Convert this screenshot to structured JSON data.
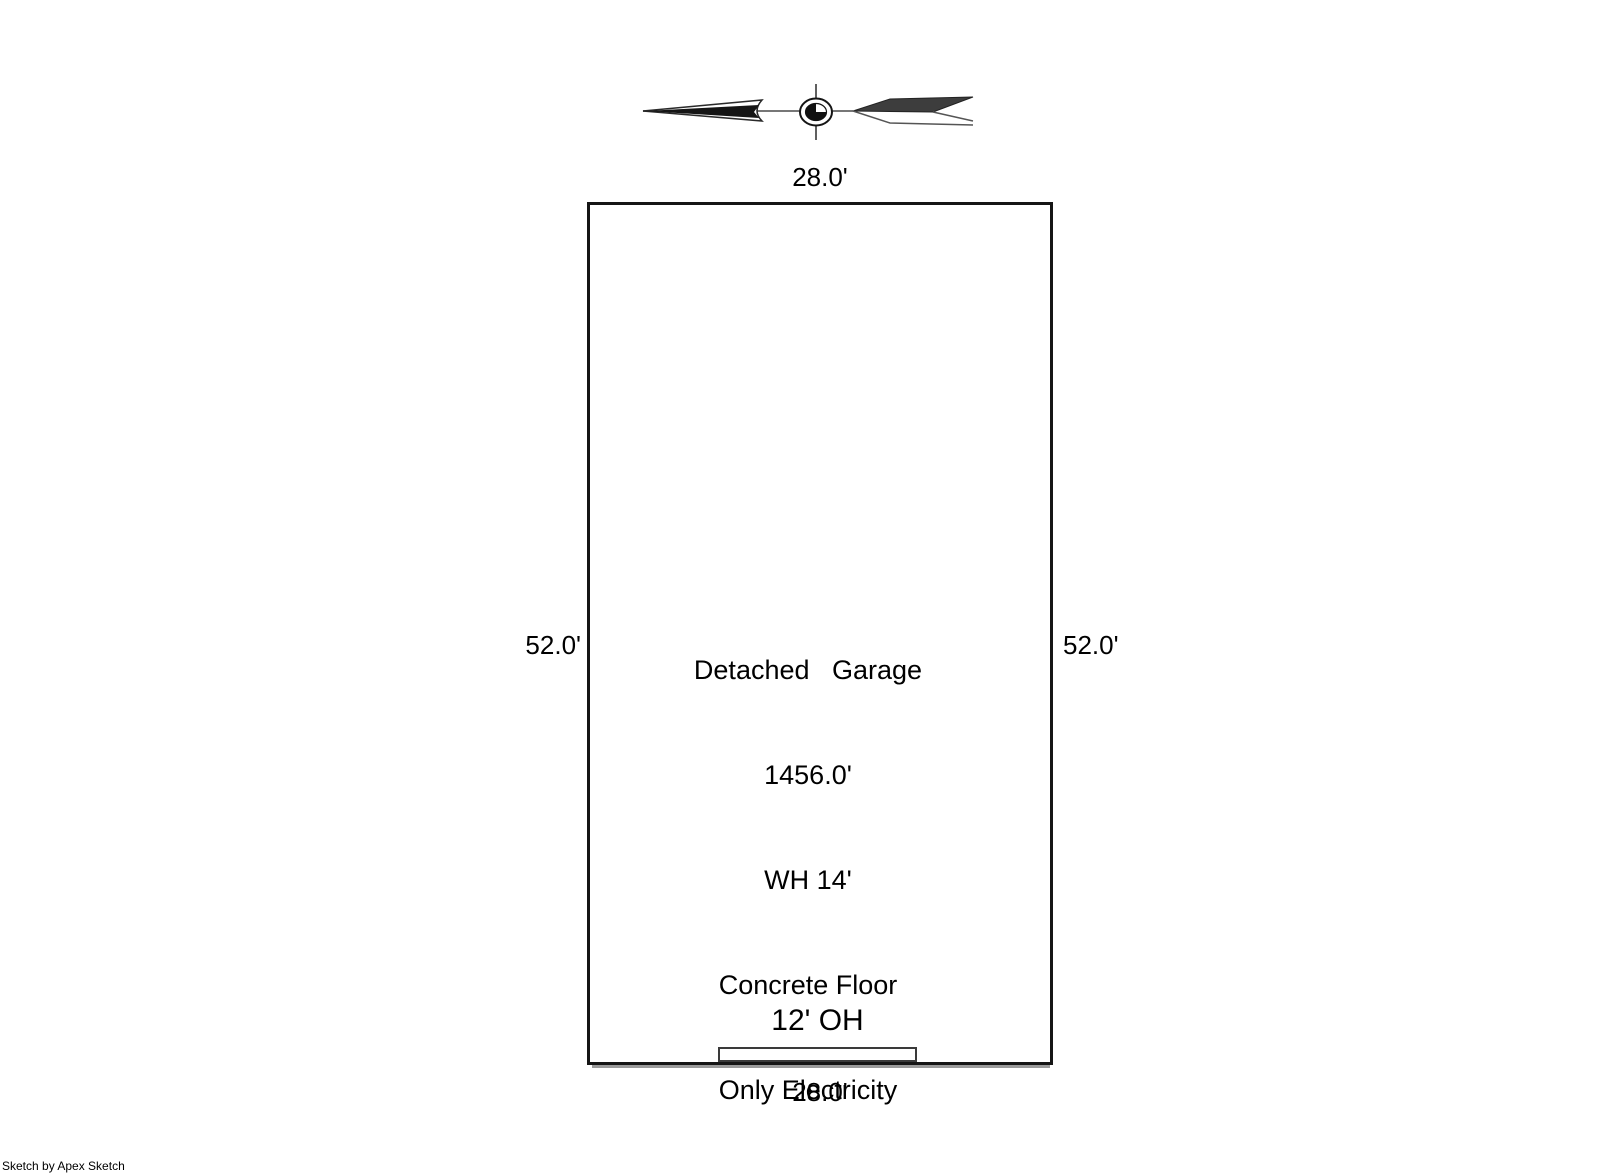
{
  "colors": {
    "background": "#ffffff",
    "wall": "#151515",
    "arrow_line": "#777777",
    "text": "#000000"
  },
  "north_arrow": {
    "icon": "north-arrow"
  },
  "sketch": {
    "dimensions": {
      "top": "28.0'",
      "bottom": "28.0'",
      "left": "52.0'",
      "right": "52.0'"
    },
    "building": {
      "labels": [
        "Detached   Garage",
        "1456.0'",
        "WH 14'",
        "Concrete Floor",
        "Only Electricity"
      ],
      "door_label": "12' OH"
    }
  },
  "footer": {
    "credit": "Sketch by Apex Sketch"
  }
}
